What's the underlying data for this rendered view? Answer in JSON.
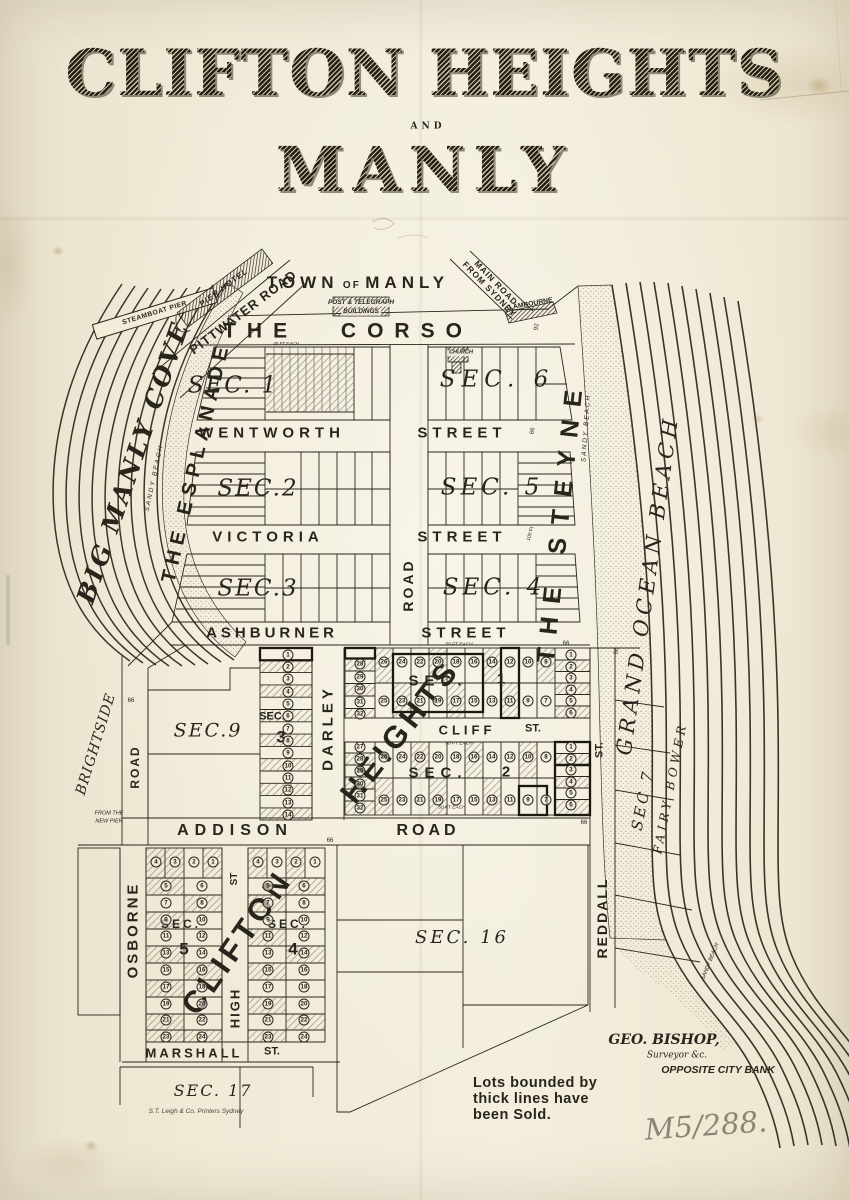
{
  "title": {
    "line1": "CLIFTON HEIGHTS",
    "and": "AND",
    "line2": "MANLY"
  },
  "top": {
    "town_w1": "TOWN",
    "town_w2": "OF",
    "town_w3": "MANLY",
    "post1": "POST & TELEGRAPH",
    "post2": "BUILDINGS",
    "corso": "THE CORSO",
    "pittwater": "PITTWATER ROAD",
    "pier_hotel": "PIER HOTEL",
    "main_road1": "MAIN ROAD",
    "main_road2": "FROM SYDNEY",
    "lambourne": "LAMBOURNE",
    "church": "CHURCH",
    "dim92": "92"
  },
  "west": {
    "steamboat": "STEAMBOAT PIER",
    "cove": "BIG MANLY COVE",
    "sandy": "SANDY BEACH",
    "esplanade": "THE ESPLANADE",
    "brightside": "BRIGHTSIDE",
    "brightside_road": "ROAD",
    "new_pier1": "FROM THE",
    "new_pier2": "NEW PIER"
  },
  "east": {
    "steyne": "THE STEYNE",
    "sandy": "SANDY BEACH",
    "ocean": "GRAND OCEAN BEACH",
    "sec7": "SEC 7",
    "fairy": "FAIRY BOWER",
    "sandy_s": "SANDY BEACH",
    "reddall_st": "ST.",
    "reddall": "REDDALL"
  },
  "streets": {
    "wentworth": "WENTWORTH",
    "wentworth2": "STREET",
    "victoria": "VICTORIA",
    "victoria2": "STREET",
    "ashburner": "ASHBURNER",
    "ashburner2": "STREET",
    "darley_road": "ROAD",
    "darley": "DARLEY",
    "cliff": "CLIFF",
    "cliff_st": "ST.",
    "addison": "ADDISON",
    "addison_road": "ROAD",
    "osborne": "OSBORNE",
    "high_st": "ST",
    "high": "HIGH",
    "marshall": "MARSHALL",
    "marshall_st": "ST."
  },
  "sections": {
    "m1": "SEC. 1",
    "m2": "SEC.2",
    "m3": "SEC.3",
    "m4": "SEC. 4",
    "m5": "SEC. 5",
    "m6": "SEC. 6",
    "s9": "SEC.9",
    "strip_label": "SEC.",
    "strip_num": "3",
    "h1_label": "SEC.",
    "h1_num": "1",
    "h2_label": "SEC.",
    "h2_num": "2",
    "heights": "HEIGHTS",
    "c5_label": "SEC.",
    "c5_num": "5",
    "c4_label": "SEC.",
    "c4_num": "4",
    "clifton": "CLIFTON",
    "s16": "SEC. 16",
    "s17": "SEC. 17"
  },
  "lots": {
    "hs1_left": [
      28,
      29,
      30,
      31,
      32
    ],
    "hs1_top": [
      26,
      24,
      22,
      20,
      18,
      16,
      14,
      12,
      10,
      8
    ],
    "hs1_bottom": [
      25,
      23,
      21,
      19,
      17,
      15,
      13,
      11,
      9,
      7
    ],
    "hs1_right": [
      1,
      2,
      3,
      4,
      5,
      6
    ],
    "hs2_left": [
      27,
      28,
      29,
      30,
      31,
      32
    ],
    "hs2_top": [
      26,
      24,
      22,
      20,
      18,
      16,
      14,
      12,
      10,
      8
    ],
    "hs2_bottom": [
      25,
      23,
      21,
      19,
      17,
      15,
      13,
      11,
      9,
      7
    ],
    "hs2_right": [
      1,
      2,
      3,
      4,
      5,
      6
    ],
    "strip": [
      1,
      2,
      3,
      4,
      5,
      6,
      7,
      8,
      9,
      10,
      11,
      12,
      13,
      14
    ],
    "c5_top": [
      4,
      3,
      2,
      1
    ],
    "c5_left": [
      5,
      7,
      9,
      11,
      13,
      15,
      17,
      19,
      21,
      23
    ],
    "c5_right": [
      6,
      8,
      10,
      12,
      14,
      16,
      18,
      20,
      22,
      24
    ],
    "c4_top": [
      4,
      3,
      2,
      1
    ],
    "c4_left": [
      5,
      7,
      9,
      11,
      13,
      15,
      17,
      19,
      21,
      23
    ],
    "c4_right": [
      6,
      8,
      10,
      12,
      14,
      16,
      18,
      20,
      22,
      24
    ]
  },
  "notes": {
    "sold1": "Lots bounded by",
    "sold2": "thick lines have",
    "sold3": "been Sold.",
    "surveyor1": "GEO. BISHOP,",
    "surveyor2": "Surveyor &c.",
    "surveyor3": "OPPOSITE CITY BANK",
    "imprint": "S.T. Leigh & Co. Printers Sydney",
    "catalog": "M5/288.",
    "fifty": "50 FT EACH",
    "forty": "40 FT EACH",
    "d66": "66",
    "d100": "100 Ft"
  },
  "colors": {
    "paper": "#f0ead7",
    "ink": "#29251d",
    "pencil": "#8d8573"
  }
}
